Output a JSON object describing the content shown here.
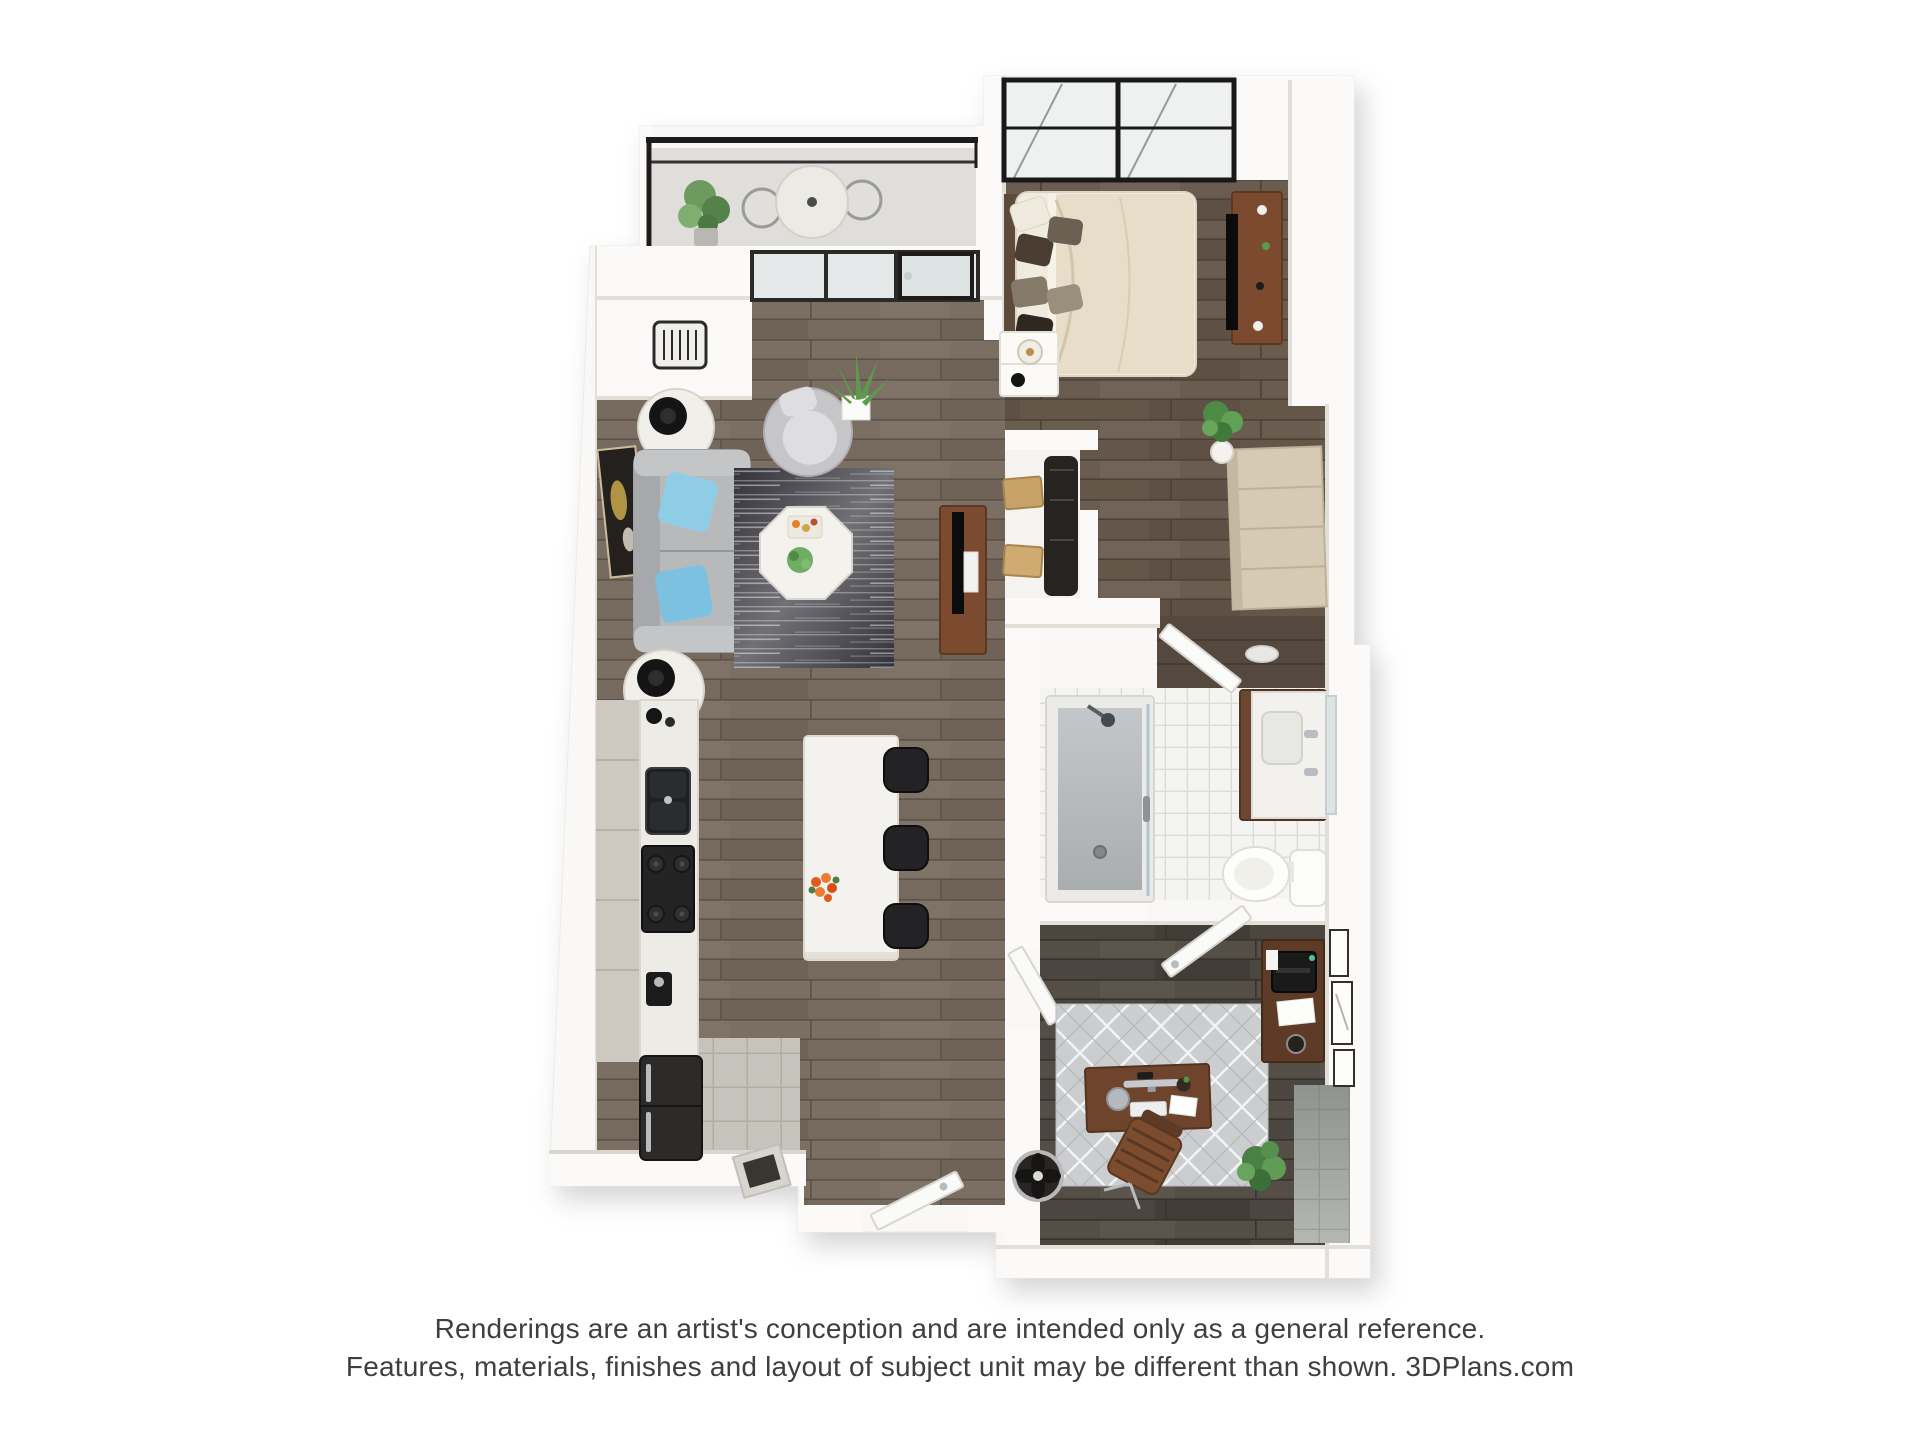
{
  "page": {
    "background": "#ffffff"
  },
  "branding": {
    "site": "3DPlans.com"
  },
  "disclaimer": {
    "line1": "Renderings are an artist's conception and are intended only as a general reference.",
    "line2": "Features, materials, finishes and layout of subject unit may be different than shown. 3DPlans.com"
  },
  "scene": {
    "type": "3d-floor-plan-top-down-rendering",
    "rooms": [
      "balcony",
      "living-room",
      "kitchen",
      "bedroom",
      "closet",
      "hallway",
      "bathroom",
      "office-den",
      "entry"
    ]
  },
  "palette": {
    "background": "#ffffff",
    "wall": "#fbfaf8",
    "wall_shade": "#e2dfd9",
    "wood_living": "#7b6f63",
    "wood_bedroom": "#6a5c4f",
    "wood_office": "#544e47",
    "kitchen_cabinet": "#cdc8c0",
    "countertop": "#edebe5",
    "island": "#f4f2ee",
    "sofa": "#b8b9bb",
    "accent_pillow_1": "#8fcde6",
    "accent_pillow_2": "#7cc2e0",
    "rug_living": "#34333a",
    "rug_office": "#cbcdcf",
    "duvet": "#e7ddc8",
    "console_wood": "#7c4a2e",
    "desk_wood": "#6e452c",
    "credenza_wood": "#5e3b26",
    "appliance_dark": "#2c2b2a",
    "tile_bath": "#f4f4f2",
    "tile_entry": "#c6c3bc",
    "tile_gray": "#b4b7b2",
    "railing": "#1c1c1c",
    "plant_green": "#5e9a4d",
    "flower_orange": "#e25a1e",
    "text": "#3f3f3f"
  }
}
